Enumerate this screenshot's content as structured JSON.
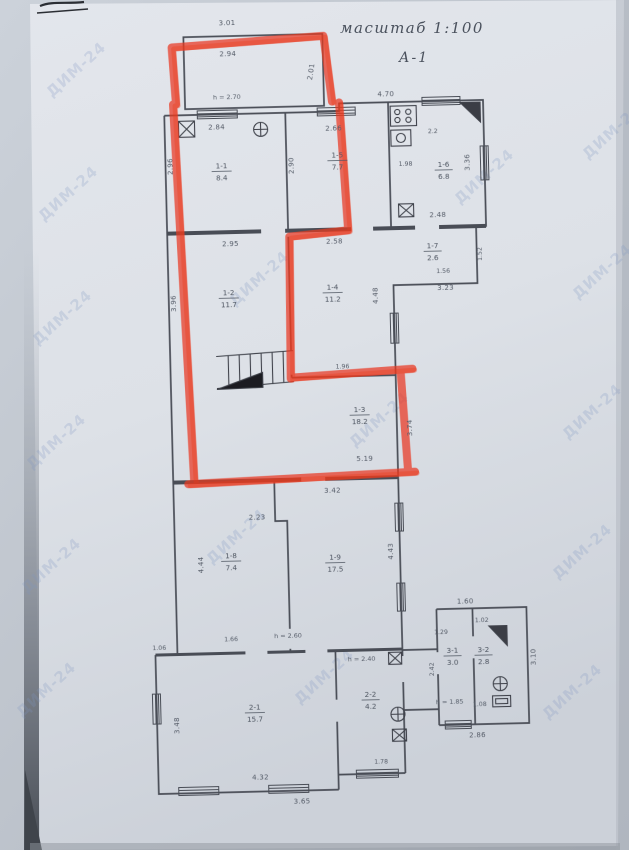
{
  "meta": {
    "scale_label": "масштаб 1:100",
    "sheet_label": "А-1",
    "watermark": "ДИМ-24"
  },
  "colors": {
    "marker_red": "#e93a20",
    "ink": "#494e57",
    "paper": "#dfe3e9",
    "watermark_blue": "#7f96c2"
  },
  "porch": {
    "top": "3.01",
    "inner": "2.94",
    "side": "2.01",
    "note": "h = 2.70"
  },
  "outer": {
    "top_right": "4.70",
    "annex_top": "1.60",
    "annex_right": "3.10",
    "annex_bottom": "2.86"
  },
  "rooms": [
    {
      "number": "1-1",
      "area": "8.4",
      "dim_top": "2.84",
      "dim_side": "2.96"
    },
    {
      "number": "1-5",
      "area": "7.7",
      "dim_top": "2.66",
      "dim_side": "2.90"
    },
    {
      "number": "1-6",
      "area": "6.8",
      "dim_top": "2.2",
      "dim_inner": "1.98",
      "dim_side": "3.36",
      "dim_bottom": "2.48"
    },
    {
      "number": "1-7",
      "area": "2.6",
      "dim_bottom": "1.56",
      "dim_outside": "3.23",
      "dim_side": "1.52"
    },
    {
      "number": "1-2",
      "area": "11.7",
      "dim_top": "2.95",
      "dim_side": "3.96"
    },
    {
      "number": "1-4",
      "area": "11.2",
      "dim_top": "2.58",
      "dim_side": "4.48",
      "dim_corner": "1.96"
    },
    {
      "number": "1-3",
      "area": "18.2",
      "dim_bottom": "5.19",
      "dim_side": "3.74"
    },
    {
      "number": "1-8",
      "area": "7.4",
      "dim_top": "2.23",
      "dim_side": "4.44",
      "dim_bottom": "1.66"
    },
    {
      "number": "1-9",
      "area": "17.5",
      "dim_top": "3.42",
      "dim_side": "4.43",
      "height_note": "h = 2.60"
    },
    {
      "number": "2-1",
      "area": "15.7",
      "dim_bottom": "4.32",
      "dim_side": "3.48",
      "dim_outside": "3.65",
      "dim_step": "1.06"
    },
    {
      "number": "2-2",
      "area": "4.2",
      "dim_window": "1.78",
      "height_note": "h = 2.40"
    },
    {
      "number": "3-1",
      "area": "3.0",
      "dim_top": "1.29",
      "dim_side": "2.42",
      "height_note": "h = 1.85"
    },
    {
      "number": "3-2",
      "area": "2.8",
      "dim_top": "1.02",
      "dim_bottom": "1.08"
    }
  ],
  "icons": [
    "stove-icon",
    "sink-icon",
    "vent-icon",
    "boiler-icon",
    "flue-icon",
    "stairs-icon",
    "bath-icon",
    "toilet-icon",
    "washbasin-icon",
    "window-hatch-icon"
  ]
}
